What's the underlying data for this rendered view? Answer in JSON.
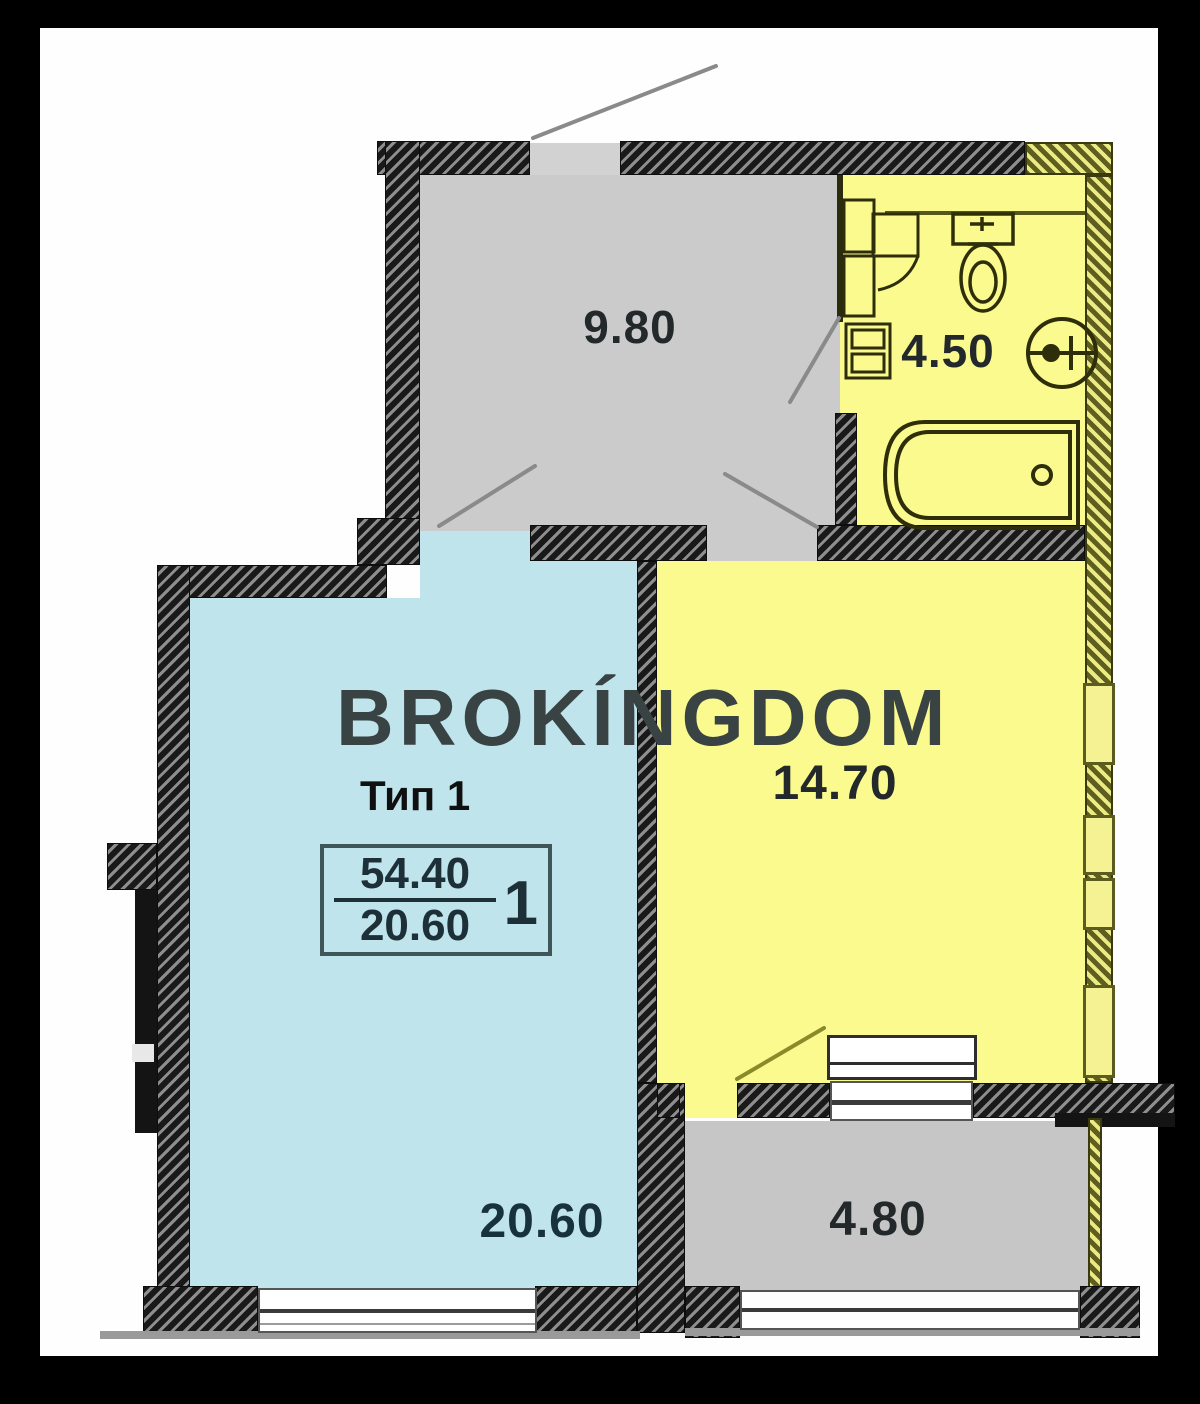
{
  "watermark": "BROKÍNGDOM",
  "plan": {
    "stamp": {
      "type_label": "Тип 1",
      "total_area": "54.40",
      "living_area": "20.60",
      "rooms_count": "1"
    },
    "rooms": [
      {
        "id": "hall",
        "area_label": "9.80",
        "fill": "#cbcbcb"
      },
      {
        "id": "bathroom",
        "area_label": "4.50",
        "fill": "#fafa8f"
      },
      {
        "id": "living-room",
        "area_label": "14.70",
        "fill": "#fafa8f"
      },
      {
        "id": "main-room",
        "area_label": "20.60",
        "fill": "#bfe4ec"
      },
      {
        "id": "balcony",
        "area_label": "4.80",
        "fill": "#c6c6c6"
      }
    ],
    "fixtures": [
      "toilet-icon",
      "washbasin-icon",
      "bathtub-icon",
      "cabinet-icon",
      "washing-machine-icon",
      "radiator-icon"
    ],
    "colors": {
      "wall_dark": "#191919",
      "wall_hatch_light": "#8e8e8e",
      "wall_olive_dark": "#5e5e1f",
      "wall_olive_light": "#ecea85",
      "room_yellow": "#fafa8f",
      "room_blue": "#bfe4ec",
      "room_gray": "#cbcbcb",
      "page": "#fefefe",
      "frame": "#000000"
    }
  }
}
